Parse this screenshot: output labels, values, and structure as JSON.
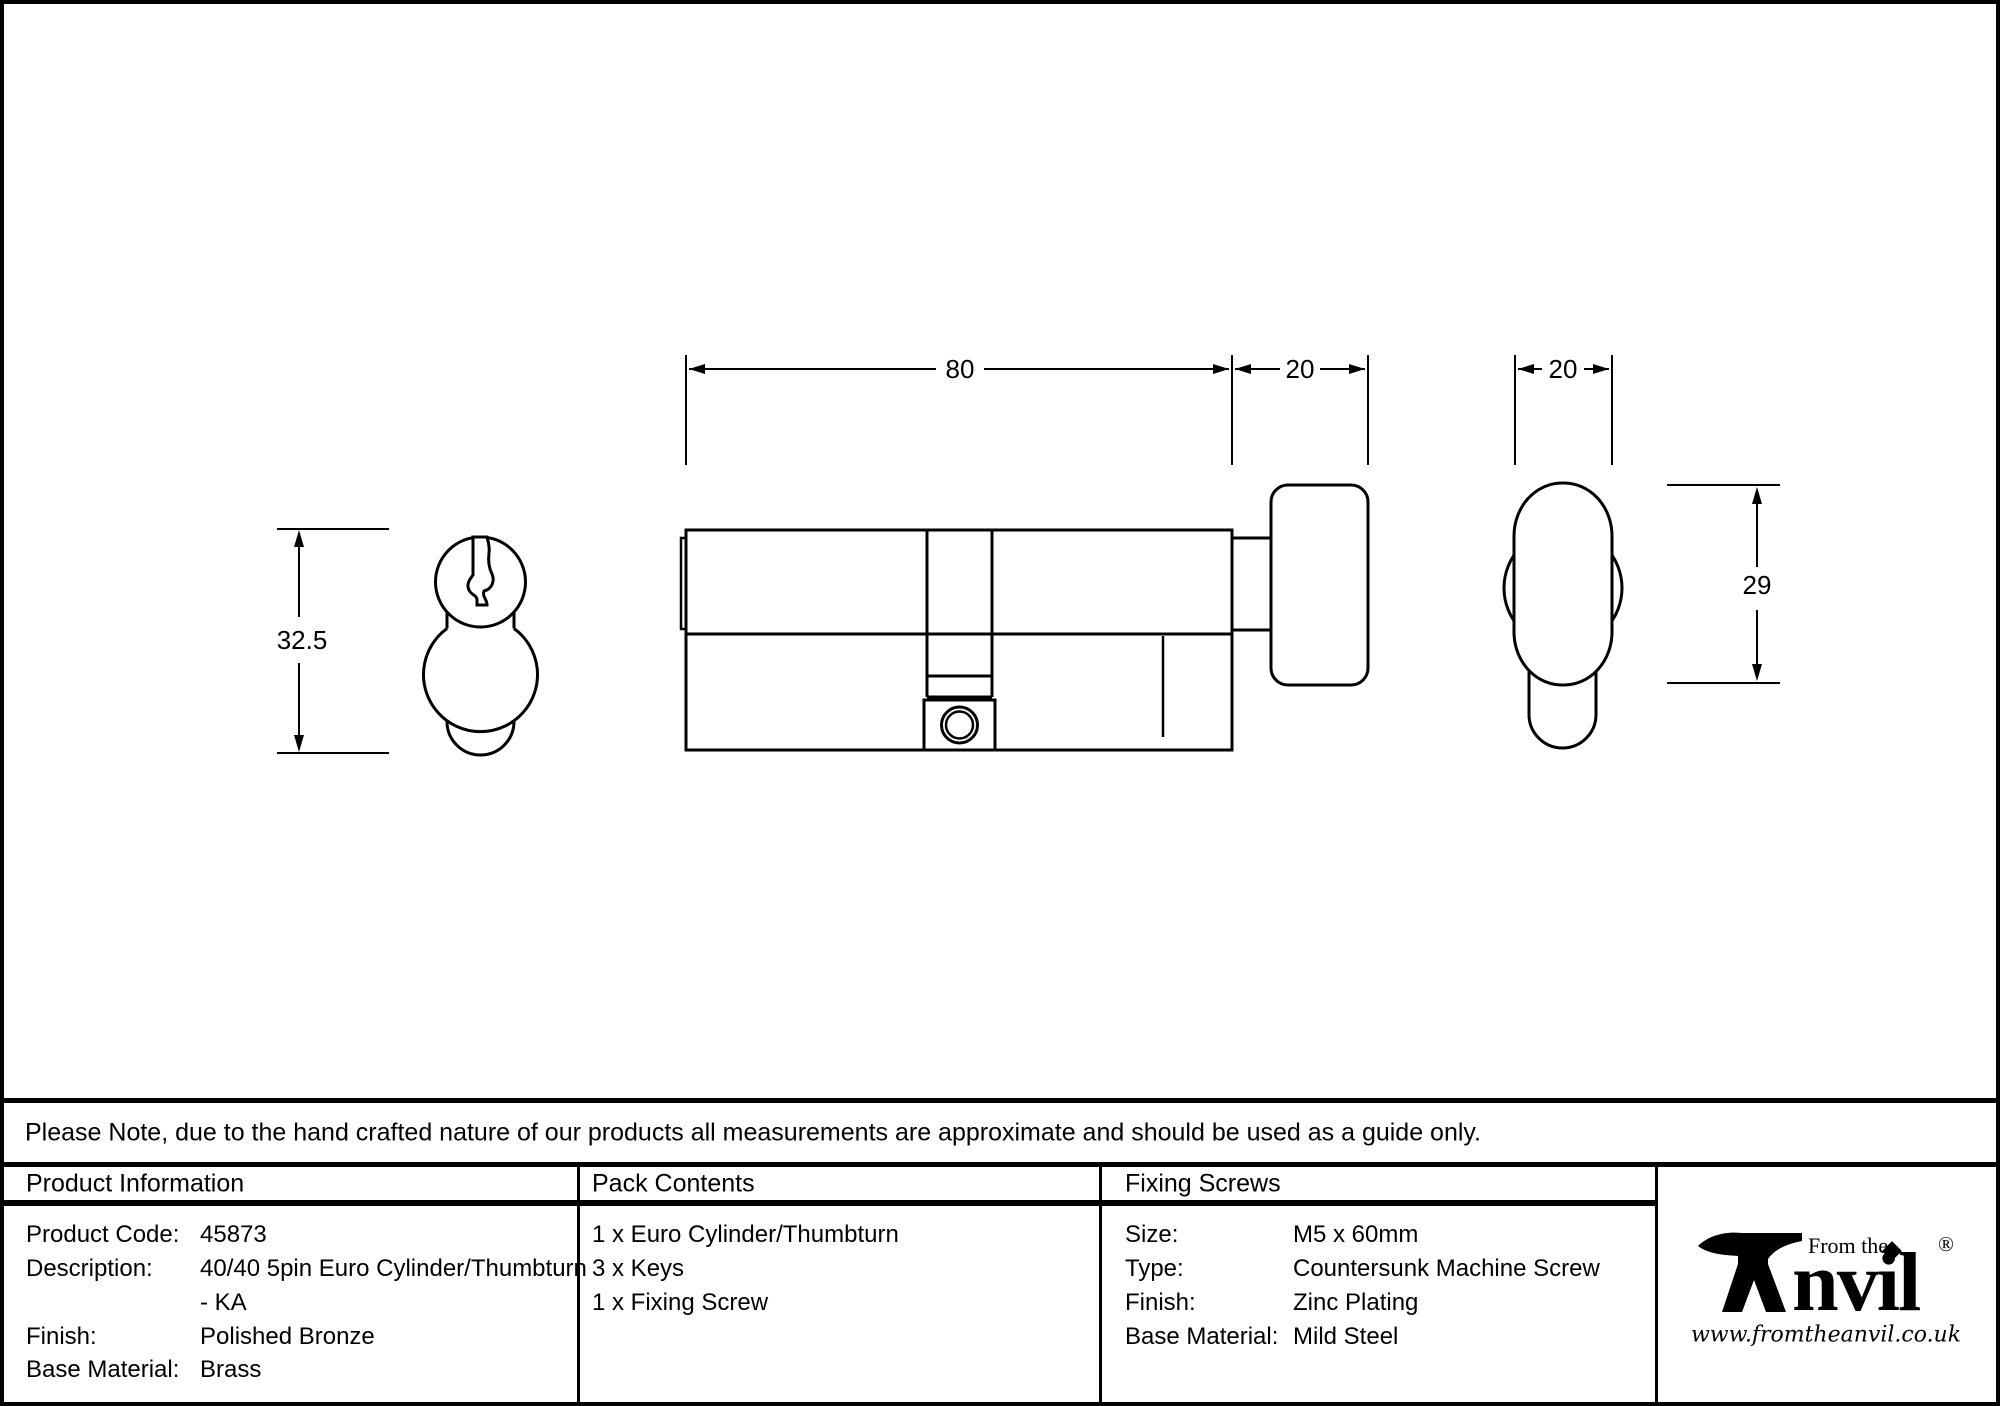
{
  "style": {
    "ink": "#000000",
    "paper": "#ffffff"
  },
  "drawing": {
    "front_view": {
      "height_dim": "32.5"
    },
    "side_view": {
      "body_length_dim": "80",
      "thumbturn_length_dim": "20"
    },
    "thumbturn_view": {
      "width_dim": "20",
      "height_dim": "29"
    }
  },
  "note": {
    "text": "Please Note, due to the hand crafted nature of our products all measurements are approximate and should be used as a guide only."
  },
  "table": {
    "product_information": {
      "header": "Product Information",
      "rows": [
        {
          "label": "Product Code:",
          "value": "45873"
        },
        {
          "label": "Description:",
          "value": "40/40 5pin Euro Cylinder/Thumbturn"
        },
        {
          "label": "",
          "value": "- KA"
        },
        {
          "label": "Finish:",
          "value": "Polished Bronze"
        },
        {
          "label": "Base Material:",
          "value": "Brass"
        }
      ]
    },
    "pack_contents": {
      "header": "Pack Contents",
      "items": [
        "1 x Euro Cylinder/Thumbturn",
        "3 x Keys",
        "1 x Fixing Screw"
      ]
    },
    "fixing_screws": {
      "header": "Fixing Screws",
      "rows": [
        {
          "label": "Size:",
          "value": "M5 x 60mm"
        },
        {
          "label": "Type:",
          "value": "Countersunk Machine Screw"
        },
        {
          "label": "Finish:",
          "value": "Zinc Plating"
        },
        {
          "label": "Base Material:",
          "value": "Mild Steel"
        }
      ]
    }
  },
  "logo": {
    "from_the": "From the",
    "anvil_word": "nvil",
    "registered": "®",
    "url": "www.fromtheanvil.co.uk"
  }
}
